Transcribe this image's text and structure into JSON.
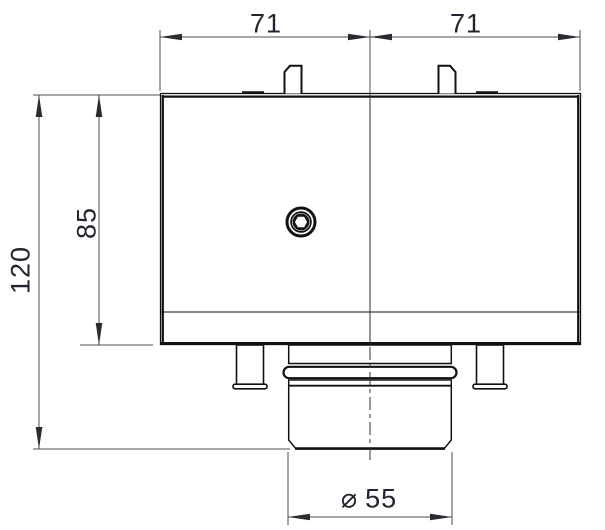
{
  "drawing": {
    "background_color": "#ffffff",
    "edge_color": "#111111",
    "dimension_line_color": "#4d4d4d",
    "text_color": "#20242e",
    "dimensions": {
      "top_width_left": "71",
      "top_width_right": "71",
      "body_height": "85",
      "overall_height": "120",
      "diameter_symbol": "⌀",
      "diameter_value": "55"
    }
  }
}
